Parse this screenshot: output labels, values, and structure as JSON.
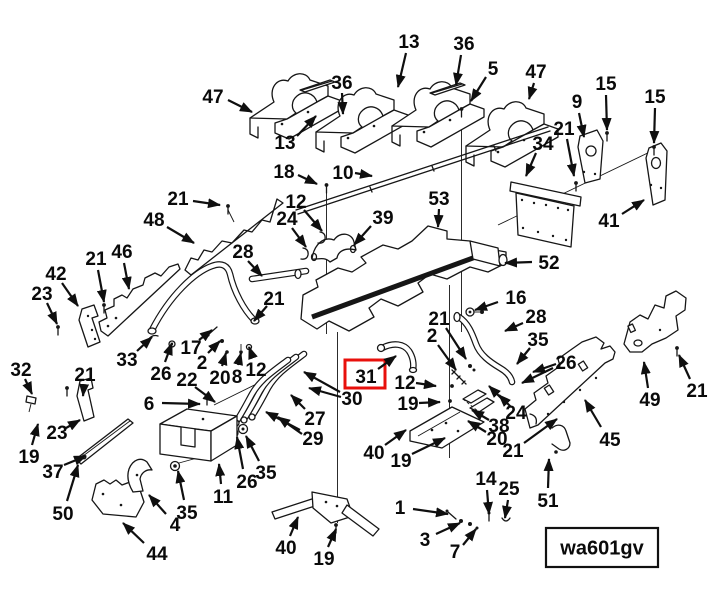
{
  "diagram": {
    "code_label": "wa601gv",
    "highlighted_callout": "31",
    "colors": {
      "line": "#161616",
      "highlight": "#e8100c",
      "background": "#ffffff"
    },
    "highlight_box": {
      "x": 345,
      "y": 360,
      "w": 40,
      "h": 28
    },
    "code_box": {
      "x": 546,
      "y": 528,
      "w": 112,
      "h": 39
    },
    "callouts": [
      {
        "n": "47",
        "x": 213,
        "y": 96,
        "a": [
          [
            228,
            100,
            252,
            112
          ]
        ]
      },
      {
        "n": "36",
        "x": 342,
        "y": 82,
        "a": [
          [
            342,
            93,
            343,
            114
          ]
        ]
      },
      {
        "n": "13",
        "x": 285,
        "y": 142,
        "a": [
          [
            297,
            136,
            316,
            116
          ]
        ]
      },
      {
        "n": "18",
        "x": 284,
        "y": 171,
        "a": [
          [
            298,
            175,
            317,
            184
          ]
        ]
      },
      {
        "n": "10",
        "x": 343,
        "y": 172,
        "a": [
          [
            355,
            173,
            372,
            176
          ]
        ]
      },
      {
        "n": "13",
        "x": 409,
        "y": 41,
        "a": [
          [
            406,
            53,
            398,
            87
          ]
        ]
      },
      {
        "n": "36",
        "x": 464,
        "y": 43,
        "a": [
          [
            461,
            55,
            456,
            85
          ]
        ]
      },
      {
        "n": "5",
        "x": 493,
        "y": 68,
        "a": [
          [
            486,
            77,
            471,
            101
          ]
        ]
      },
      {
        "n": "47",
        "x": 536,
        "y": 71,
        "a": [
          [
            534,
            83,
            529,
            99
          ]
        ]
      },
      {
        "n": "9",
        "x": 577,
        "y": 101,
        "a": [
          [
            579,
            113,
            584,
            137
          ]
        ]
      },
      {
        "n": "15",
        "x": 606,
        "y": 83,
        "a": [
          [
            606,
            95,
            607,
            130
          ]
        ]
      },
      {
        "n": "15",
        "x": 655,
        "y": 96,
        "a": [
          [
            655,
            108,
            654,
            143
          ]
        ]
      },
      {
        "n": "34",
        "x": 543,
        "y": 143,
        "a": [
          [
            536,
            153,
            526,
            176
          ]
        ]
      },
      {
        "n": "21",
        "x": 564,
        "y": 128,
        "a": [
          [
            567,
            139,
            574,
            176
          ]
        ]
      },
      {
        "n": "41",
        "x": 609,
        "y": 220,
        "a": [
          [
            622,
            214,
            644,
            200
          ]
        ]
      },
      {
        "n": "12",
        "x": 296,
        "y": 201,
        "a": [
          [
            304,
            210,
            322,
            231
          ]
        ]
      },
      {
        "n": "24",
        "x": 287,
        "y": 218,
        "a": [
          [
            292,
            228,
            306,
            247
          ]
        ]
      },
      {
        "n": "39",
        "x": 383,
        "y": 217,
        "a": [
          [
            371,
            226,
            354,
            245
          ]
        ]
      },
      {
        "n": "53",
        "x": 439,
        "y": 198,
        "a": [
          [
            439,
            209,
            438,
            227
          ]
        ]
      },
      {
        "n": "52",
        "x": 549,
        "y": 262,
        "a": [
          [
            532,
            262,
            505,
            263
          ]
        ]
      },
      {
        "n": "48",
        "x": 154,
        "y": 219,
        "a": [
          [
            167,
            227,
            194,
            243
          ]
        ]
      },
      {
        "n": "21",
        "x": 178,
        "y": 198,
        "a": [
          [
            193,
            201,
            220,
            205
          ]
        ]
      },
      {
        "n": "28",
        "x": 243,
        "y": 251,
        "a": [
          [
            248,
            261,
            262,
            276
          ]
        ]
      },
      {
        "n": "46",
        "x": 122,
        "y": 251,
        "a": [
          [
            124,
            263,
            129,
            289
          ]
        ]
      },
      {
        "n": "21",
        "x": 96,
        "y": 258,
        "a": [
          [
            98,
            270,
            104,
            302
          ]
        ]
      },
      {
        "n": "42",
        "x": 56,
        "y": 273,
        "a": [
          [
            62,
            283,
            78,
            306
          ]
        ]
      },
      {
        "n": "23",
        "x": 42,
        "y": 293,
        "a": [
          [
            47,
            303,
            57,
            324
          ]
        ]
      },
      {
        "n": "21",
        "x": 274,
        "y": 298,
        "a": [
          [
            267,
            306,
            254,
            321
          ]
        ]
      },
      {
        "n": "16",
        "x": 516,
        "y": 297,
        "a": [
          [
            498,
            302,
            475,
            310
          ]
        ]
      },
      {
        "n": "33",
        "x": 127,
        "y": 359,
        "a": [
          [
            137,
            351,
            152,
            337
          ]
        ]
      },
      {
        "n": "26",
        "x": 161,
        "y": 373,
        "a": [
          [
            165,
            362,
            172,
            343
          ]
        ]
      },
      {
        "n": "17",
        "x": 191,
        "y": 347,
        "a": [
          [
            199,
            340,
            212,
            330
          ]
        ]
      },
      {
        "n": "2",
        "x": 202,
        "y": 362,
        "a": [
          [
            208,
            353,
            220,
            341
          ]
        ]
      },
      {
        "n": "20",
        "x": 220,
        "y": 377,
        "a": [
          [
            222,
            366,
            226,
            353
          ]
        ]
      },
      {
        "n": "8",
        "x": 237,
        "y": 376,
        "a": [
          [
            238,
            365,
            241,
            353
          ]
        ]
      },
      {
        "n": "12",
        "x": 256,
        "y": 369,
        "a": [
          [
            253,
            358,
            249,
            347
          ]
        ]
      },
      {
        "n": "22",
        "x": 187,
        "y": 379,
        "a": [
          [
            195,
            387,
            215,
            402
          ]
        ]
      },
      {
        "n": "6",
        "x": 149,
        "y": 403,
        "a": [
          [
            162,
            403,
            200,
            404
          ]
        ]
      },
      {
        "n": "21",
        "x": 85,
        "y": 374,
        "a": [
          [
            84,
            385,
            83,
            396
          ]
        ]
      },
      {
        "n": "32",
        "x": 21,
        "y": 369,
        "a": [
          [
            25,
            379,
            32,
            394
          ]
        ]
      },
      {
        "n": "23",
        "x": 57,
        "y": 432,
        "a": [
          [
            66,
            428,
            80,
            420
          ]
        ]
      },
      {
        "n": "19",
        "x": 29,
        "y": 456,
        "a": [
          [
            32,
            445,
            38,
            424
          ]
        ]
      },
      {
        "n": "37",
        "x": 53,
        "y": 471,
        "a": [
          [
            64,
            465,
            86,
            456
          ]
        ]
      },
      {
        "n": "50",
        "x": 63,
        "y": 513,
        "a": [
          [
            67,
            501,
            78,
            465
          ]
        ]
      },
      {
        "n": "44",
        "x": 157,
        "y": 553,
        "a": [
          [
            144,
            543,
            123,
            523
          ]
        ]
      },
      {
        "n": "4",
        "x": 175,
        "y": 524,
        "a": [
          [
            166,
            514,
            149,
            495
          ]
        ]
      },
      {
        "n": "35",
        "x": 187,
        "y": 512,
        "a": [
          [
            184,
            500,
            178,
            471
          ]
        ]
      },
      {
        "n": "26",
        "x": 247,
        "y": 481,
        "a": [
          [
            243,
            469,
            237,
            437
          ]
        ]
      },
      {
        "n": "35",
        "x": 266,
        "y": 472,
        "a": [
          [
            259,
            461,
            246,
            436
          ]
        ]
      },
      {
        "n": "11",
        "x": 223,
        "y": 496,
        "a": [
          [
            221,
            484,
            219,
            464
          ]
        ]
      },
      {
        "n": "27",
        "x": 315,
        "y": 418,
        "a": [
          [
            305,
            409,
            291,
            395
          ]
        ]
      },
      {
        "n": "29",
        "x": 313,
        "y": 438,
        "a": [
          [
            300,
            430,
            266,
            412
          ],
          [
            302,
            434,
            278,
            417
          ]
        ]
      },
      {
        "n": "30",
        "x": 352,
        "y": 398,
        "a": [
          [
            340,
            392,
            304,
            372
          ],
          [
            341,
            397,
            309,
            388
          ]
        ]
      },
      {
        "n": "21",
        "x": 439,
        "y": 318,
        "a": [
          [
            446,
            328,
            466,
            359
          ]
        ]
      },
      {
        "n": "2",
        "x": 432,
        "y": 335,
        "a": [
          [
            438,
            345,
            456,
            370
          ]
        ]
      },
      {
        "n": "28",
        "x": 536,
        "y": 316,
        "a": [
          [
            523,
            323,
            505,
            331
          ]
        ]
      },
      {
        "n": "35",
        "x": 538,
        "y": 339,
        "a": [
          [
            530,
            348,
            517,
            364
          ]
        ]
      },
      {
        "n": "26",
        "x": 566,
        "y": 362,
        "a": [
          [
            553,
            368,
            522,
            383
          ],
          [
            556,
            364,
            533,
            372
          ]
        ]
      },
      {
        "n": "31",
        "x": 366,
        "y": 376,
        "a": [
          [
            378,
            369,
            396,
            356
          ]
        ]
      },
      {
        "n": "12",
        "x": 405,
        "y": 382,
        "a": [
          [
            416,
            383,
            436,
            386
          ]
        ]
      },
      {
        "n": "19",
        "x": 408,
        "y": 403,
        "a": [
          [
            419,
            403,
            440,
            402
          ]
        ]
      },
      {
        "n": "24",
        "x": 516,
        "y": 412,
        "a": [
          [
            507,
            404,
            489,
            386
          ],
          [
            511,
            407,
            499,
            395
          ]
        ]
      },
      {
        "n": "38",
        "x": 499,
        "y": 425,
        "a": [
          [
            489,
            420,
            472,
            410
          ]
        ]
      },
      {
        "n": "20",
        "x": 497,
        "y": 438,
        "a": [
          [
            486,
            432,
            468,
            421
          ]
        ]
      },
      {
        "n": "21",
        "x": 513,
        "y": 450,
        "a": [
          [
            524,
            443,
            557,
            419
          ]
        ]
      },
      {
        "n": "40",
        "x": 374,
        "y": 452,
        "a": [
          [
            385,
            445,
            406,
            430
          ]
        ]
      },
      {
        "n": "19",
        "x": 401,
        "y": 460,
        "a": [
          [
            412,
            454,
            445,
            438
          ]
        ]
      },
      {
        "n": "45",
        "x": 610,
        "y": 439,
        "a": [
          [
            601,
            427,
            585,
            400
          ]
        ]
      },
      {
        "n": "49",
        "x": 650,
        "y": 399,
        "a": [
          [
            648,
            388,
            644,
            362
          ]
        ]
      },
      {
        "n": "21",
        "x": 697,
        "y": 390,
        "a": [
          [
            690,
            379,
            679,
            355
          ]
        ]
      },
      {
        "n": "51",
        "x": 548,
        "y": 500,
        "a": [
          [
            548,
            488,
            549,
            459
          ]
        ]
      },
      {
        "n": "40",
        "x": 286,
        "y": 547,
        "a": [
          [
            290,
            536,
            298,
            517
          ]
        ]
      },
      {
        "n": "19",
        "x": 324,
        "y": 558,
        "a": [
          [
            328,
            547,
            336,
            529
          ]
        ]
      },
      {
        "n": "14",
        "x": 486,
        "y": 478,
        "a": [
          [
            487,
            490,
            489,
            514
          ]
        ]
      },
      {
        "n": "25",
        "x": 509,
        "y": 488,
        "a": [
          [
            508,
            500,
            505,
            518
          ]
        ]
      },
      {
        "n": "1",
        "x": 400,
        "y": 507,
        "a": [
          [
            413,
            509,
            448,
            514
          ]
        ]
      },
      {
        "n": "3",
        "x": 425,
        "y": 539,
        "a": [
          [
            436,
            534,
            460,
            523
          ]
        ]
      },
      {
        "n": "7",
        "x": 455,
        "y": 551,
        "a": [
          [
            463,
            545,
            476,
            529
          ]
        ]
      }
    ]
  }
}
